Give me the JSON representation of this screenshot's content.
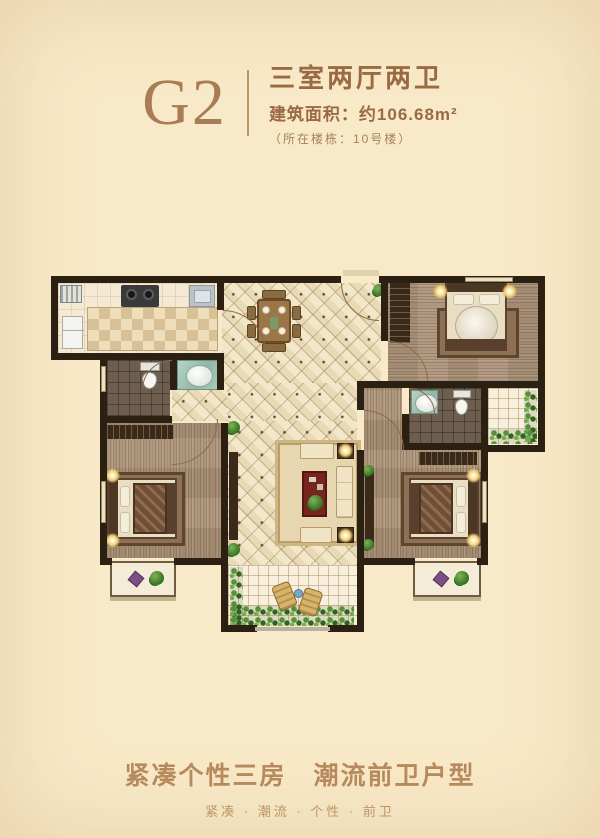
{
  "header": {
    "plan_code": "G2",
    "layout_type": "三室两厅两卫",
    "area": "建筑面积：约106.68m²",
    "building_note": "（所在楼栋：10号楼）"
  },
  "footer": {
    "slogan": "紧凑个性三房　潮流前卫户型",
    "tagline": "紧凑 · 潮流 · 个性 · 前卫"
  },
  "colors": {
    "page_bg": "#f8e9c8",
    "accent": "#a87c54",
    "title_brown": "#9a6a42",
    "footer_brown": "#b68a5c",
    "wall": "#2c2013"
  }
}
